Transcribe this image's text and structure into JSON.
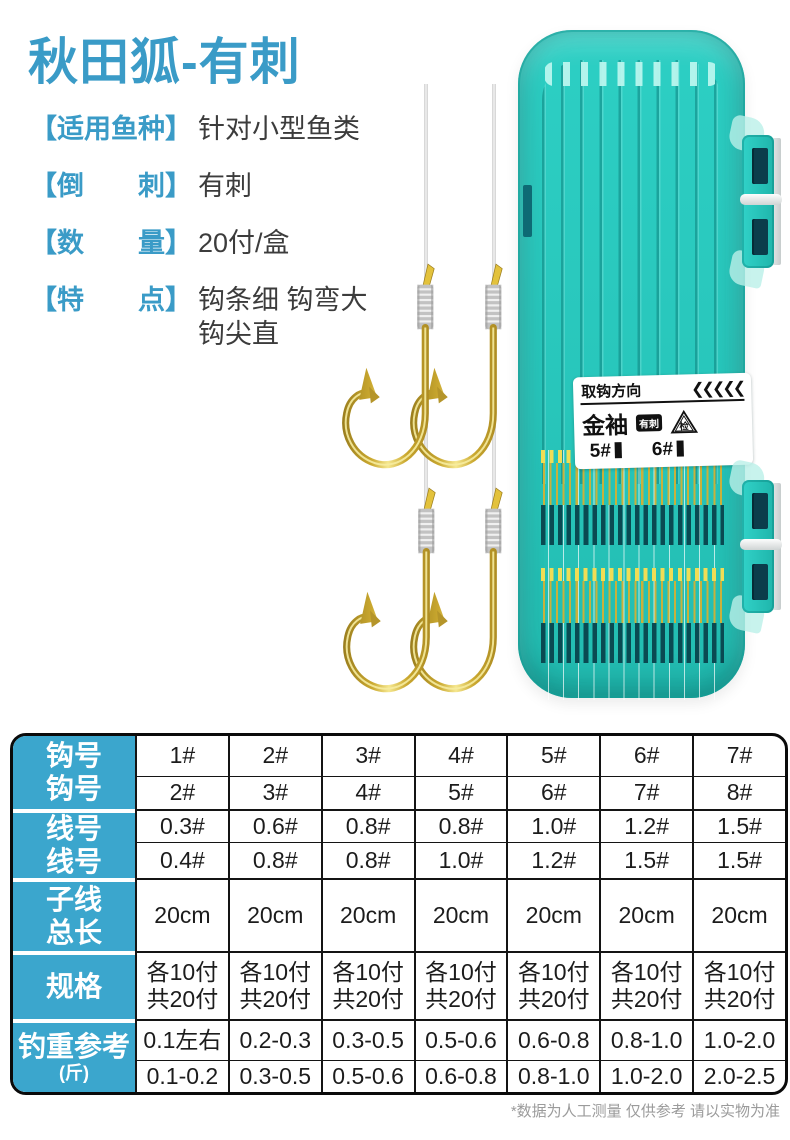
{
  "title": "秋田狐-有刺",
  "specs": [
    {
      "label": "【适用鱼种】",
      "value": "针对小型鱼类"
    },
    {
      "label": "【倒　　刺】",
      "value": "有刺"
    },
    {
      "label": "【数　　量】",
      "value": "20付/盒"
    },
    {
      "label": "【特　　点】",
      "value": "钩条细 钩弯大\n钩尖直"
    }
  ],
  "box_label": {
    "direction": "取钩方向",
    "arrows": "❮❮❮❮❮",
    "brand": "金袖",
    "badge": "有刺",
    "check": "检",
    "size1": "5#",
    "size2": "6#"
  },
  "table": {
    "row_groups": [
      {
        "header": [
          "钩号",
          "钩号"
        ],
        "rows": [
          [
            "1#",
            "2#",
            "3#",
            "4#",
            "5#",
            "6#",
            "7#"
          ],
          [
            "2#",
            "3#",
            "4#",
            "5#",
            "6#",
            "7#",
            "8#"
          ]
        ]
      },
      {
        "header": [
          "线号",
          "线号"
        ],
        "rows": [
          [
            "0.3#",
            "0.6#",
            "0.8#",
            "0.8#",
            "1.0#",
            "1.2#",
            "1.5#"
          ],
          [
            "0.4#",
            "0.8#",
            "0.8#",
            "1.0#",
            "1.2#",
            "1.5#",
            "1.5#"
          ]
        ]
      },
      {
        "header": [
          "子线",
          "总长"
        ],
        "rows": [
          [
            "20cm",
            "20cm",
            "20cm",
            "20cm",
            "20cm",
            "20cm",
            "20cm"
          ]
        ]
      },
      {
        "header": [
          "规格"
        ],
        "rows": [
          [
            "各10付\n共20付",
            "各10付\n共20付",
            "各10付\n共20付",
            "各10付\n共20付",
            "各10付\n共20付",
            "各10付\n共20付",
            "各10付\n共20付"
          ]
        ]
      },
      {
        "header": [
          "钓重参考",
          "(斤)"
        ],
        "rows": [
          [
            "0.1左右",
            "0.2-0.3",
            "0.3-0.5",
            "0.5-0.6",
            "0.6-0.8",
            "0.8-1.0",
            "1.0-2.0"
          ],
          [
            "0.1-0.2",
            "0.3-0.5",
            "0.5-0.6",
            "0.6-0.8",
            "0.8-1.0",
            "1.0-2.0",
            "2.0-2.5"
          ]
        ]
      }
    ]
  },
  "footer_note": "*数据为人工测量 仅供参考 请以实物为准",
  "colors": {
    "accent": "#3A9BC7",
    "table_header": "#3BA6CD",
    "box_teal": "#2DCFC4",
    "hook_gold": "#C9A62E"
  }
}
